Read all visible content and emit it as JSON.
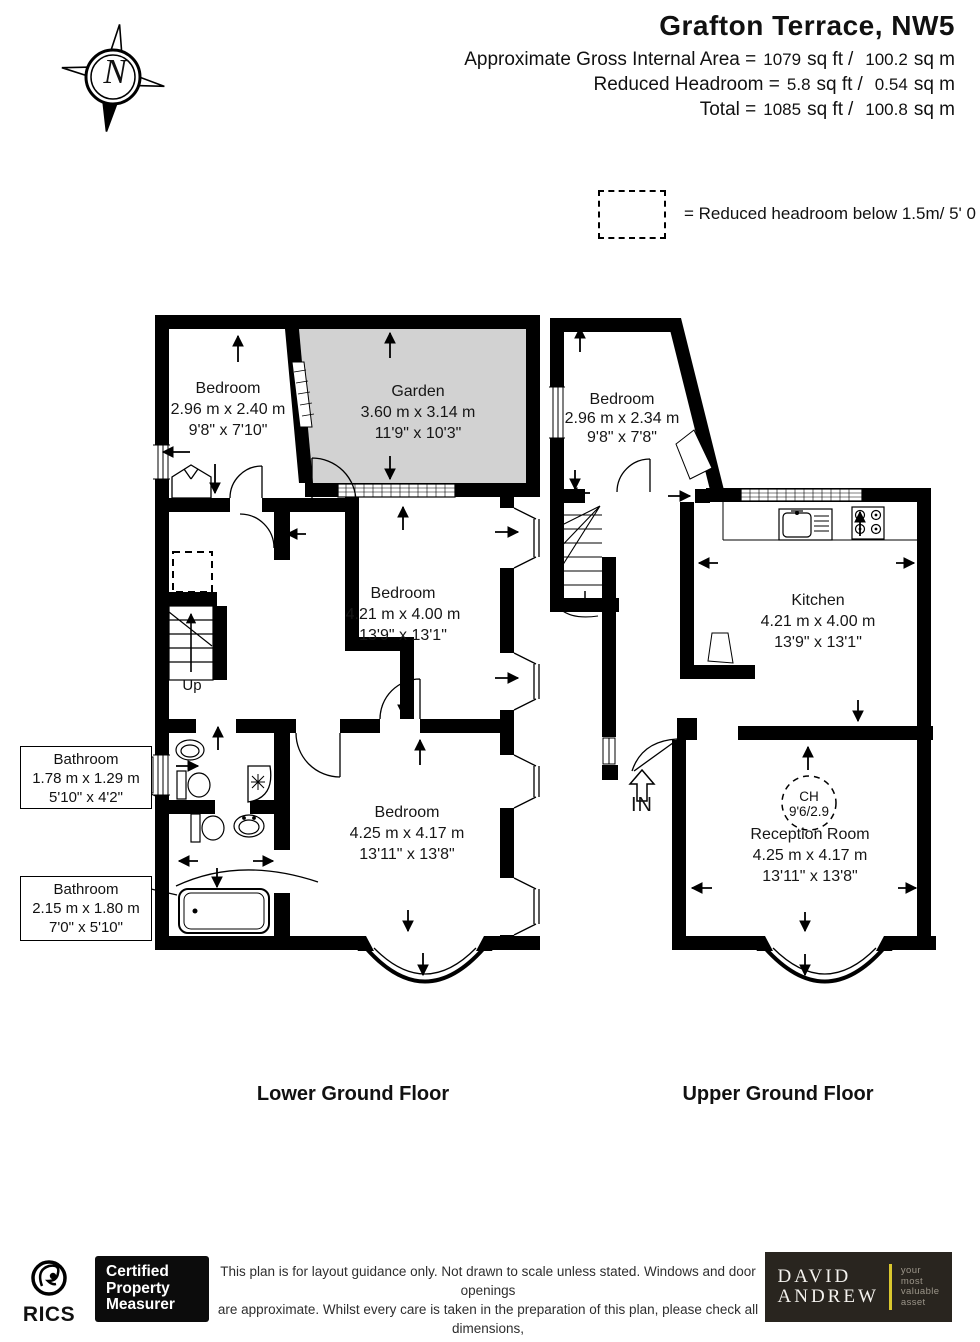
{
  "header": {
    "title": "Grafton Terrace, NW5",
    "rows": [
      {
        "label": "Approximate Gross Internal Area =",
        "ft": "1079",
        "ftu": "sq ft",
        "sep": "/",
        "m": "100.2",
        "mu": "sq m"
      },
      {
        "label": "Reduced Headroom =",
        "ft": "5.8",
        "ftu": "sq ft",
        "sep": "/",
        "m": "0.54",
        "mu": "sq m"
      },
      {
        "label": "Total =",
        "ft": "1085",
        "ftu": "sq ft",
        "sep": "/",
        "m": "100.8",
        "mu": "sq m"
      }
    ]
  },
  "legend": {
    "text": "= Reduced headroom below 1.5m/ 5' 0"
  },
  "compass": {
    "label": "N"
  },
  "lower_floor": {
    "name": "Lower Ground Floor",
    "stairs_label": "Up",
    "rooms": {
      "bedroom1": {
        "name": "Bedroom",
        "metric": "2.96 m x 2.40 m",
        "imperial": "9'8\" x 7'10\""
      },
      "garden": {
        "name": "Garden",
        "metric": "3.60 m x 3.14 m",
        "imperial": "11'9\" x 10'3\""
      },
      "bedroom2": {
        "name": "Bedroom",
        "metric": "4.21 m x 4.00 m",
        "imperial": "13'9\" x 13'1\""
      },
      "bedroom3": {
        "name": "Bedroom",
        "metric": "4.25 m x 4.17 m",
        "imperial": "13'11\" x 13'8\""
      },
      "bathroom1": {
        "name": "Bathroom",
        "metric": "1.78 m x 1.29 m",
        "imperial": "5'10\" x 4'2\""
      },
      "bathroom2": {
        "name": "Bathroom",
        "metric": "2.15 m x 1.80 m",
        "imperial": "7'0\" x 5'10\""
      }
    }
  },
  "upper_floor": {
    "name": "Upper Ground Floor",
    "entrance_label": "IN",
    "ch_label": "CH",
    "ch_value": "9'6/2.9",
    "rooms": {
      "bedroom": {
        "name": "Bedroom",
        "metric": "2.96 m x 2.34 m",
        "imperial": "9'8\" x 7'8\""
      },
      "kitchen": {
        "name": "Kitchen",
        "metric": "4.21 m x 4.00 m",
        "imperial": "13'9\" x 13'1\""
      },
      "reception": {
        "name": "Reception Room",
        "metric": "4.25 m x 4.17 m",
        "imperial": "13'11\" x 13'8\""
      }
    }
  },
  "footer": {
    "rics": "RICS",
    "cert_lines": [
      "Certified",
      "Property",
      "Measurer"
    ],
    "disclaimer_lines": [
      "This plan is for layout guidance only. Not drawn to scale unless stated. Windows and door openings",
      "are approximate. Whilst every care is taken in the preparation of this plan, please check all dimensions,",
      "shapes and compass bearings before making any decisions reliant upon them."
    ],
    "brand": {
      "name_line1": "DAVID",
      "name_line2": "ANDREW",
      "tagline_lines": [
        "your",
        "most",
        "valuable",
        "asset"
      ]
    }
  },
  "colors": {
    "garden_fill": "#d2d2d2",
    "wall": "#000000",
    "accent": "#d9c72e"
  }
}
